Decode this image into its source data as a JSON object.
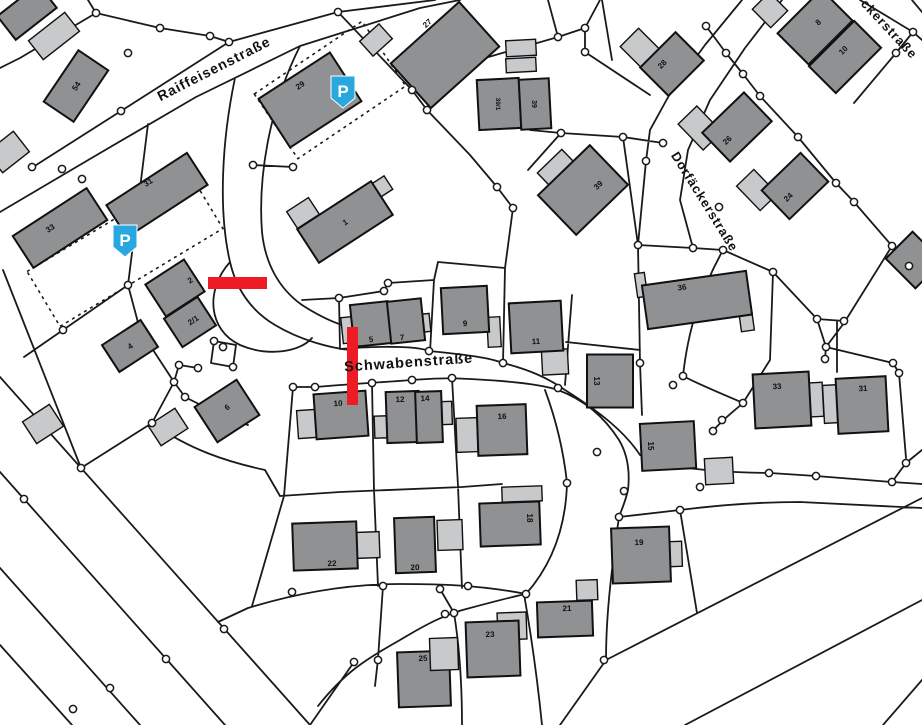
{
  "map": {
    "type": "cadastral-parcel-map",
    "colors": {
      "background": "#ffffff",
      "parcel_line": "#1a1a1a",
      "building_dark": "#8f9192",
      "building_light": "#c7c9ca",
      "building_stroke": "#111111",
      "marker_red": "#ed1c24",
      "parking_blue": "#29a8df",
      "parking_glyph": "#ffffff"
    },
    "streets": [
      {
        "name": "Raiffeisenstraße",
        "x": 216,
        "y": 73,
        "rot": -27,
        "size": 14
      },
      {
        "name": "Schwabenstraße",
        "x": 409,
        "y": 367,
        "rot": -4,
        "size": 14.5
      },
      {
        "name": "Dorfäckerstraße",
        "x": 701,
        "y": 204,
        "rot": 58,
        "size": 13
      },
      {
        "name": "ckerstraße",
        "x": 886,
        "y": 32,
        "rot": 47,
        "size": 13
      }
    ],
    "parking_icons": [
      {
        "label": "P",
        "cx": 125,
        "cy": 241
      },
      {
        "label": "P",
        "cx": 343,
        "cy": 92
      }
    ],
    "markers": [
      {
        "id": "blocked-segment-horizontal",
        "x": 208,
        "y": 277,
        "w": 59,
        "h": 12
      },
      {
        "id": "blocked-segment-vertical",
        "x": 347,
        "y": 327,
        "w": 11,
        "h": 78
      }
    ],
    "buildings": [
      {
        "x": 27,
        "y": 12,
        "w": 52,
        "h": 30,
        "r": -38,
        "s": "d",
        "l": ""
      },
      {
        "x": 54,
        "y": 36,
        "w": 46,
        "h": 24,
        "r": -38,
        "s": "l",
        "l": ""
      },
      {
        "x": 8,
        "y": 152,
        "w": 34,
        "h": 26,
        "r": -38,
        "s": "l",
        "l": ""
      },
      {
        "x": 76,
        "y": 86,
        "w": 62,
        "h": 36,
        "r": -56,
        "s": "d",
        "l": "54"
      },
      {
        "x": 157,
        "y": 195,
        "w": 96,
        "h": 38,
        "r": -33,
        "s": "d",
        "l": "31",
        "lx": -9,
        "ly": -13
      },
      {
        "x": 60,
        "y": 228,
        "w": 88,
        "h": 38,
        "r": -33,
        "s": "d",
        "l": "33",
        "lx": -10,
        "ly": 0
      },
      {
        "x": 175,
        "y": 288,
        "w": 46,
        "h": 38,
        "r": -33,
        "s": "d",
        "l": "2",
        "lx": 15,
        "ly": -8
      },
      {
        "x": 190,
        "y": 322,
        "w": 40,
        "h": 34,
        "r": -33,
        "s": "d",
        "l": "2/1",
        "lx": 3,
        "ly": -2
      },
      {
        "x": 130,
        "y": 346,
        "w": 46,
        "h": 32,
        "r": -33,
        "s": "d",
        "l": "4"
      },
      {
        "x": 43,
        "y": 424,
        "w": 32,
        "h": 26,
        "r": -33,
        "s": "l",
        "l": ""
      },
      {
        "x": 168,
        "y": 427,
        "w": 32,
        "h": 24,
        "r": -33,
        "s": "l",
        "l": ""
      },
      {
        "x": 227,
        "y": 411,
        "w": 50,
        "h": 42,
        "r": -33,
        "s": "d",
        "l": "6",
        "ly": -4
      },
      {
        "x": 310,
        "y": 100,
        "w": 85,
        "h": 58,
        "r": -33,
        "s": "d",
        "l": "29",
        "lx": -10,
        "ly": -15
      },
      {
        "x": 376,
        "y": 40,
        "w": 26,
        "h": 20,
        "r": -42,
        "s": "l",
        "l": ""
      },
      {
        "x": 445,
        "y": 55,
        "w": 92,
        "h": 60,
        "r": -42,
        "s": "d",
        "l": "27",
        "lx": -18,
        "ly": -32
      },
      {
        "x": 303,
        "y": 213,
        "w": 26,
        "h": 20,
        "r": -33,
        "s": "l",
        "l": ""
      },
      {
        "x": 380,
        "y": 188,
        "w": 20,
        "h": 16,
        "r": -33,
        "s": "l",
        "l": ""
      },
      {
        "x": 345,
        "y": 222,
        "w": 88,
        "h": 40,
        "r": -33,
        "s": "d",
        "l": "1"
      },
      {
        "x": 521,
        "y": 48,
        "w": 30,
        "h": 16,
        "r": -3,
        "s": "l",
        "l": ""
      },
      {
        "x": 521,
        "y": 65,
        "w": 30,
        "h": 14,
        "r": -3,
        "s": "l",
        "l": ""
      },
      {
        "x": 499,
        "y": 104,
        "w": 42,
        "h": 50,
        "r": -3,
        "s": "d",
        "l": "39/1",
        "lr": 90,
        "fs": 6.5
      },
      {
        "x": 535,
        "y": 104,
        "w": 30,
        "h": 50,
        "r": -3,
        "s": "d",
        "l": "39",
        "lr": 90,
        "fs": 7
      },
      {
        "x": 560,
        "y": 172,
        "w": 34,
        "h": 30,
        "r": -44,
        "s": "l",
        "l": ""
      },
      {
        "x": 583,
        "y": 190,
        "w": 72,
        "h": 55,
        "r": -44,
        "s": "d",
        "l": "39",
        "lx": 15,
        "ly": -5
      },
      {
        "x": 640,
        "y": 48,
        "w": 26,
        "h": 30,
        "r": -45,
        "s": "l",
        "l": ""
      },
      {
        "x": 672,
        "y": 64,
        "w": 50,
        "h": 40,
        "r": -45,
        "s": "d",
        "l": "28",
        "lx": -10,
        "ly": 0
      },
      {
        "x": 770,
        "y": 10,
        "w": 24,
        "h": 26,
        "r": -45,
        "s": "l",
        "l": ""
      },
      {
        "x": 815,
        "y": 27,
        "w": 62,
        "h": 44,
        "r": -45,
        "s": "d",
        "l": "8",
        "lx": 3,
        "ly": -5
      },
      {
        "x": 845,
        "y": 57,
        "w": 64,
        "h": 38,
        "r": -45,
        "s": "d",
        "l": "10",
        "lx": -2,
        "ly": -7
      },
      {
        "x": 700,
        "y": 128,
        "w": 26,
        "h": 36,
        "r": -44,
        "s": "l",
        "l": ""
      },
      {
        "x": 737,
        "y": 127,
        "w": 58,
        "h": 40,
        "r": -44,
        "s": "d",
        "l": "26",
        "lx": -10,
        "ly": 13
      },
      {
        "x": 757,
        "y": 190,
        "w": 24,
        "h": 34,
        "r": -44,
        "s": "l",
        "l": ""
      },
      {
        "x": 795,
        "y": 186,
        "w": 54,
        "h": 40,
        "r": -44,
        "s": "d",
        "l": "24",
        "lx": -7,
        "ly": 11
      },
      {
        "x": 914,
        "y": 260,
        "w": 38,
        "h": 42,
        "r": -45,
        "s": "d",
        "l": ""
      },
      {
        "x": 349,
        "y": 330,
        "w": 14,
        "h": 26,
        "r": -6,
        "s": "l",
        "l": ""
      },
      {
        "x": 424,
        "y": 323,
        "w": 12,
        "h": 18,
        "r": -6,
        "s": "l",
        "l": ""
      },
      {
        "x": 371,
        "y": 324,
        "w": 38,
        "h": 42,
        "r": -6,
        "s": "d",
        "l": "5",
        "ly": 15
      },
      {
        "x": 406,
        "y": 321,
        "w": 34,
        "h": 42,
        "r": -6,
        "s": "d",
        "l": "7",
        "lx": -4,
        "ly": 16
      },
      {
        "x": 494,
        "y": 332,
        "w": 13,
        "h": 30,
        "r": -3,
        "s": "l",
        "l": ""
      },
      {
        "x": 465,
        "y": 310,
        "w": 46,
        "h": 46,
        "r": -3,
        "s": "d",
        "l": "9",
        "ly": 13
      },
      {
        "x": 555,
        "y": 362,
        "w": 26,
        "h": 25,
        "r": -3,
        "s": "l",
        "l": ""
      },
      {
        "x": 536,
        "y": 327,
        "w": 52,
        "h": 50,
        "r": -3,
        "s": "d",
        "l": "11",
        "ly": 14
      },
      {
        "x": 610,
        "y": 381,
        "w": 46,
        "h": 53,
        "r": 0,
        "s": "d",
        "l": "13",
        "lr": 90,
        "lx": -13
      },
      {
        "x": 641,
        "y": 285,
        "w": 10,
        "h": 24,
        "r": -8,
        "s": "l",
        "l": ""
      },
      {
        "x": 746,
        "y": 317,
        "w": 13,
        "h": 28,
        "r": -8,
        "s": "l",
        "l": ""
      },
      {
        "x": 697,
        "y": 300,
        "w": 105,
        "h": 44,
        "r": -8,
        "s": "d",
        "l": "36",
        "lx": -15,
        "ly": -13
      },
      {
        "x": 809,
        "y": 400,
        "w": 28,
        "h": 34,
        "r": -3,
        "s": "l",
        "l": ""
      },
      {
        "x": 782,
        "y": 400,
        "w": 56,
        "h": 54,
        "r": -3,
        "s": "d",
        "l": "33",
        "lx": -5,
        "ly": -14
      },
      {
        "x": 831,
        "y": 404,
        "w": 15,
        "h": 38,
        "r": -3,
        "s": "l",
        "l": ""
      },
      {
        "x": 862,
        "y": 405,
        "w": 50,
        "h": 55,
        "r": -3,
        "s": "d",
        "l": "31",
        "lx": 1,
        "ly": -17
      },
      {
        "x": 668,
        "y": 446,
        "w": 54,
        "h": 47,
        "r": -3,
        "s": "d",
        "l": "15",
        "lr": 90,
        "lx": -17
      },
      {
        "x": 719,
        "y": 471,
        "w": 28,
        "h": 26,
        "r": -3,
        "s": "l",
        "l": ""
      },
      {
        "x": 307,
        "y": 424,
        "w": 19,
        "h": 28,
        "r": -4,
        "s": "l",
        "l": ""
      },
      {
        "x": 341,
        "y": 415,
        "w": 52,
        "h": 45,
        "r": -4,
        "s": "d",
        "l": "10",
        "lx": -3,
        "ly": -12
      },
      {
        "x": 446,
        "y": 413,
        "w": 12,
        "h": 23,
        "r": -2,
        "s": "l",
        "l": ""
      },
      {
        "x": 381,
        "y": 427,
        "w": 13,
        "h": 22,
        "r": -2,
        "s": "l",
        "l": ""
      },
      {
        "x": 403,
        "y": 417,
        "w": 33,
        "h": 51,
        "r": -2,
        "s": "d",
        "l": "12",
        "lx": -3,
        "ly": -18
      },
      {
        "x": 429,
        "y": 417,
        "w": 26,
        "h": 51,
        "r": -2,
        "s": "d",
        "l": "14",
        "lx": -4,
        "ly": -19
      },
      {
        "x": 467,
        "y": 435,
        "w": 21,
        "h": 34,
        "r": -2,
        "s": "l",
        "l": ""
      },
      {
        "x": 502,
        "y": 430,
        "w": 49,
        "h": 50,
        "r": -2,
        "s": "d",
        "l": "16",
        "ly": -14
      },
      {
        "x": 522,
        "y": 494,
        "w": 40,
        "h": 15,
        "r": -2,
        "s": "l",
        "l": ""
      },
      {
        "x": 510,
        "y": 524,
        "w": 60,
        "h": 43,
        "r": -2,
        "s": "d",
        "l": "18",
        "lr": 90,
        "lx": 20,
        "ly": -6
      },
      {
        "x": 368,
        "y": 545,
        "w": 23,
        "h": 26,
        "r": -2,
        "s": "l",
        "l": ""
      },
      {
        "x": 325,
        "y": 546,
        "w": 64,
        "h": 47,
        "r": -2,
        "s": "d",
        "l": "22",
        "lx": 7,
        "ly": 17
      },
      {
        "x": 450,
        "y": 535,
        "w": 25,
        "h": 30,
        "r": -2,
        "s": "l",
        "l": ""
      },
      {
        "x": 415,
        "y": 545,
        "w": 40,
        "h": 55,
        "r": -2,
        "s": "d",
        "l": "20",
        "ly": 22
      },
      {
        "x": 675,
        "y": 554,
        "w": 14,
        "h": 25,
        "r": -2,
        "s": "l",
        "l": ""
      },
      {
        "x": 641,
        "y": 555,
        "w": 58,
        "h": 55,
        "r": -2,
        "s": "d",
        "l": "19",
        "lx": -2,
        "ly": -13
      },
      {
        "x": 587,
        "y": 590,
        "w": 21,
        "h": 20,
        "r": -2,
        "s": "l",
        "l": ""
      },
      {
        "x": 565,
        "y": 619,
        "w": 55,
        "h": 35,
        "r": -2,
        "s": "d",
        "l": "21",
        "lx": 2,
        "ly": -11
      },
      {
        "x": 512,
        "y": 626,
        "w": 29,
        "h": 27,
        "r": -2,
        "s": "l",
        "l": ""
      },
      {
        "x": 493,
        "y": 649,
        "w": 53,
        "h": 55,
        "r": -2,
        "s": "d",
        "l": "23",
        "lx": -3,
        "ly": -15
      },
      {
        "x": 424,
        "y": 679,
        "w": 52,
        "h": 55,
        "r": -2,
        "s": "d",
        "l": "25",
        "lx": -1,
        "ly": -21
      },
      {
        "x": 444,
        "y": 654,
        "w": 28,
        "h": 32,
        "r": -2,
        "s": "l",
        "l": ""
      }
    ]
  }
}
